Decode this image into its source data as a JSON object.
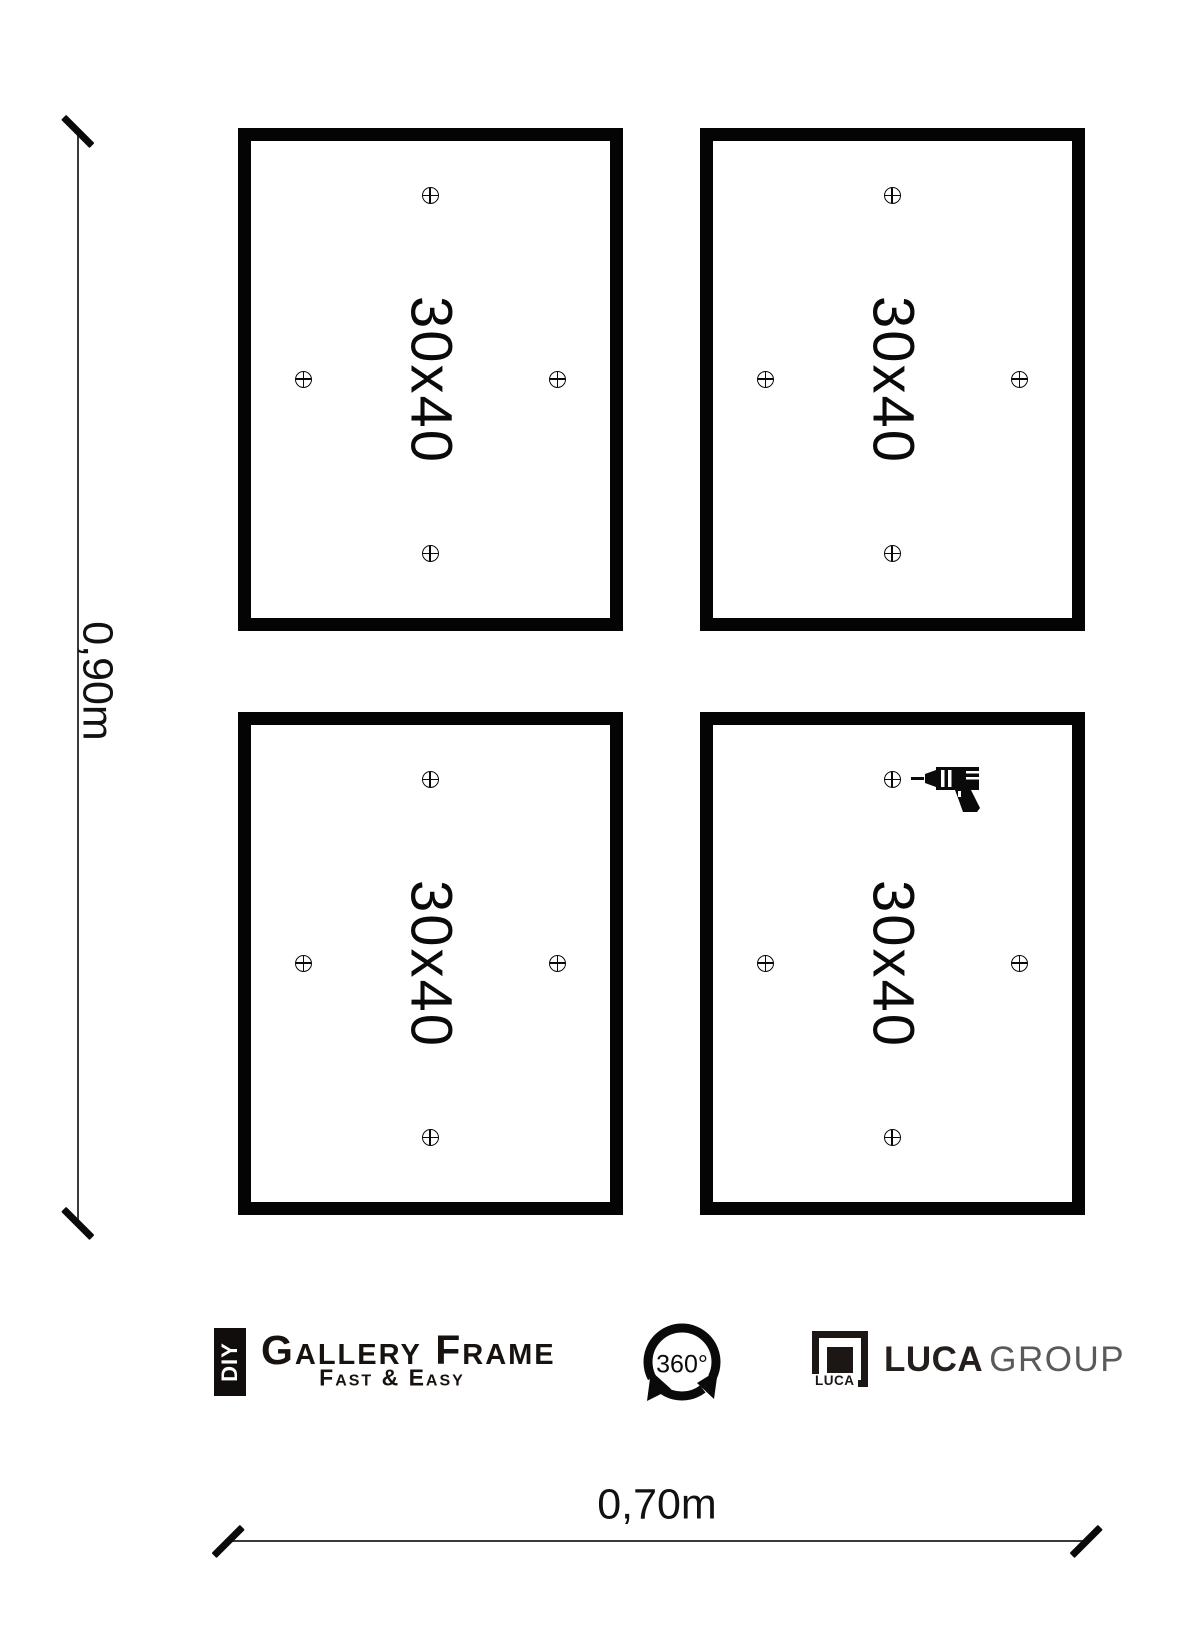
{
  "page": {
    "background": "#ffffff",
    "ink": "#000000",
    "gray": "#5a5a5a"
  },
  "dimensions": {
    "height_label": "0,90m",
    "width_label": "0,70m"
  },
  "frames": [
    {
      "id": "top-left",
      "label": "30x40"
    },
    {
      "id": "top-right",
      "label": "30x40"
    },
    {
      "id": "bottom-left",
      "label": "30x40"
    },
    {
      "id": "bottom-right",
      "label": "30x40",
      "drill_icon": true
    }
  ],
  "footer": {
    "diy_badge": "DIY",
    "brand": "Gallery Frame",
    "tagline": "Fast & Easy",
    "rotation_label": "360°",
    "luca_logo_small_text": "LUCA",
    "luca_name": "LUCA",
    "luca_group": "GROUP"
  },
  "icons": {
    "drill": "power-drill-icon",
    "rotation": "360-rotation-arrows-icon",
    "marker": "crosshair-drill-hole-marker-icon"
  }
}
